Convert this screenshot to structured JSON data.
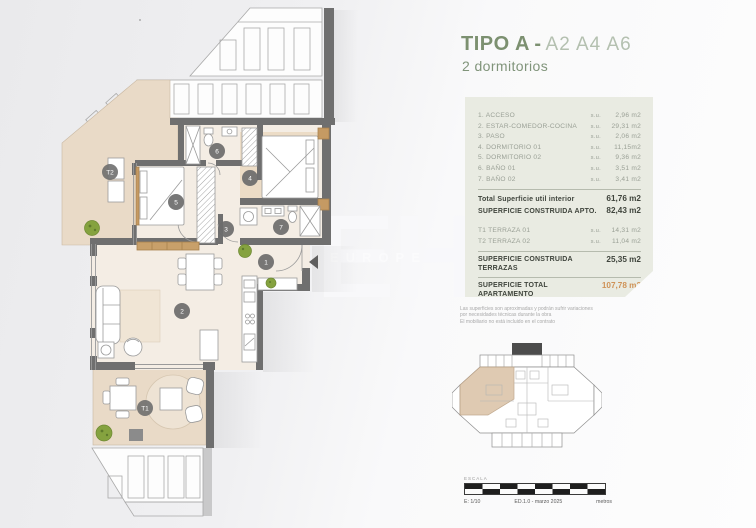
{
  "header": {
    "title_bold": "TIPO A",
    "title_dash": "-",
    "title_units": "A2 A4 A6",
    "subtitle": "2 dormitorios"
  },
  "area_table": {
    "rooms": [
      {
        "label": "1. ACCESO",
        "su": "s.u.",
        "value": "2,96 m2"
      },
      {
        "label": "2. ESTAR-COMEDOR-COCINA",
        "su": "s.u.",
        "value": "29,31 m2"
      },
      {
        "label": "3. PASO",
        "su": "s.u.",
        "value": "2,06 m2"
      },
      {
        "label": "4. DORMITORIO 01",
        "su": "s.u.",
        "value": "11,15m2"
      },
      {
        "label": "5. DORMITORIO 02",
        "su": "s.u.",
        "value": "9,36 m2"
      },
      {
        "label": "6. BAÑO 01",
        "su": "s.u.",
        "value": "3,51 m2"
      },
      {
        "label": "7. BAÑO 02",
        "su": "s.u.",
        "value": "3,41 m2"
      }
    ],
    "total_util": {
      "label": "Total Superficie util interior",
      "value": "61,76 m2"
    },
    "construida_apto": {
      "label": "SUPERFICIE CONSTRUIDA APTO.",
      "value": "82,43 m2"
    },
    "terrazas": [
      {
        "label": "T1 TERRAZA 01",
        "su": "s.u.",
        "value": "14,31 m2"
      },
      {
        "label": "T2 TERRAZA 02",
        "su": "s.u.",
        "value": "11,04 m2"
      }
    ],
    "construida_terrazas": {
      "label_line1": "SUPERFICIE CONSTRUIDA",
      "label_line2": "TERRAZAS",
      "value": "25,35 m2"
    },
    "total_apartamento": {
      "label_line1": "SUPERFICIE TOTAL",
      "label_line2": "APARTAMENTO",
      "value": "107,78 m2"
    }
  },
  "disclaimer": {
    "line1": "Las superficies son aproximadas y podrán sufrir variaciones",
    "line2": "por necesidades técnicas durante la obra",
    "line3": "El mobiliario no está incluido en el contrato"
  },
  "scale_bar": {
    "label": "ESCALA",
    "scale": "E: 1/10",
    "edition": "ED.1.0 - marzo 2025",
    "units": "metros"
  },
  "watermark": {
    "initials": "EH",
    "word": "EUROPE"
  },
  "floor_plan": {
    "markers": [
      {
        "id": "1"
      },
      {
        "id": "2"
      },
      {
        "id": "3"
      },
      {
        "id": "4"
      },
      {
        "id": "5"
      },
      {
        "id": "6"
      },
      {
        "id": "7"
      },
      {
        "id": "T1"
      },
      {
        "id": "T2"
      }
    ]
  },
  "colors": {
    "accent_green": "#7c9070",
    "accent_green_light": "#b4c0b0",
    "panel_background": "#e9ebe2",
    "total_orange": "#cf9257",
    "wall_gray": "#6f6f6f",
    "terrace_beige": "#e9dac7",
    "interior_cream": "#f4ede4",
    "tree_green": "#85a23f",
    "keyplan_highlight": "#dcc5aa"
  }
}
